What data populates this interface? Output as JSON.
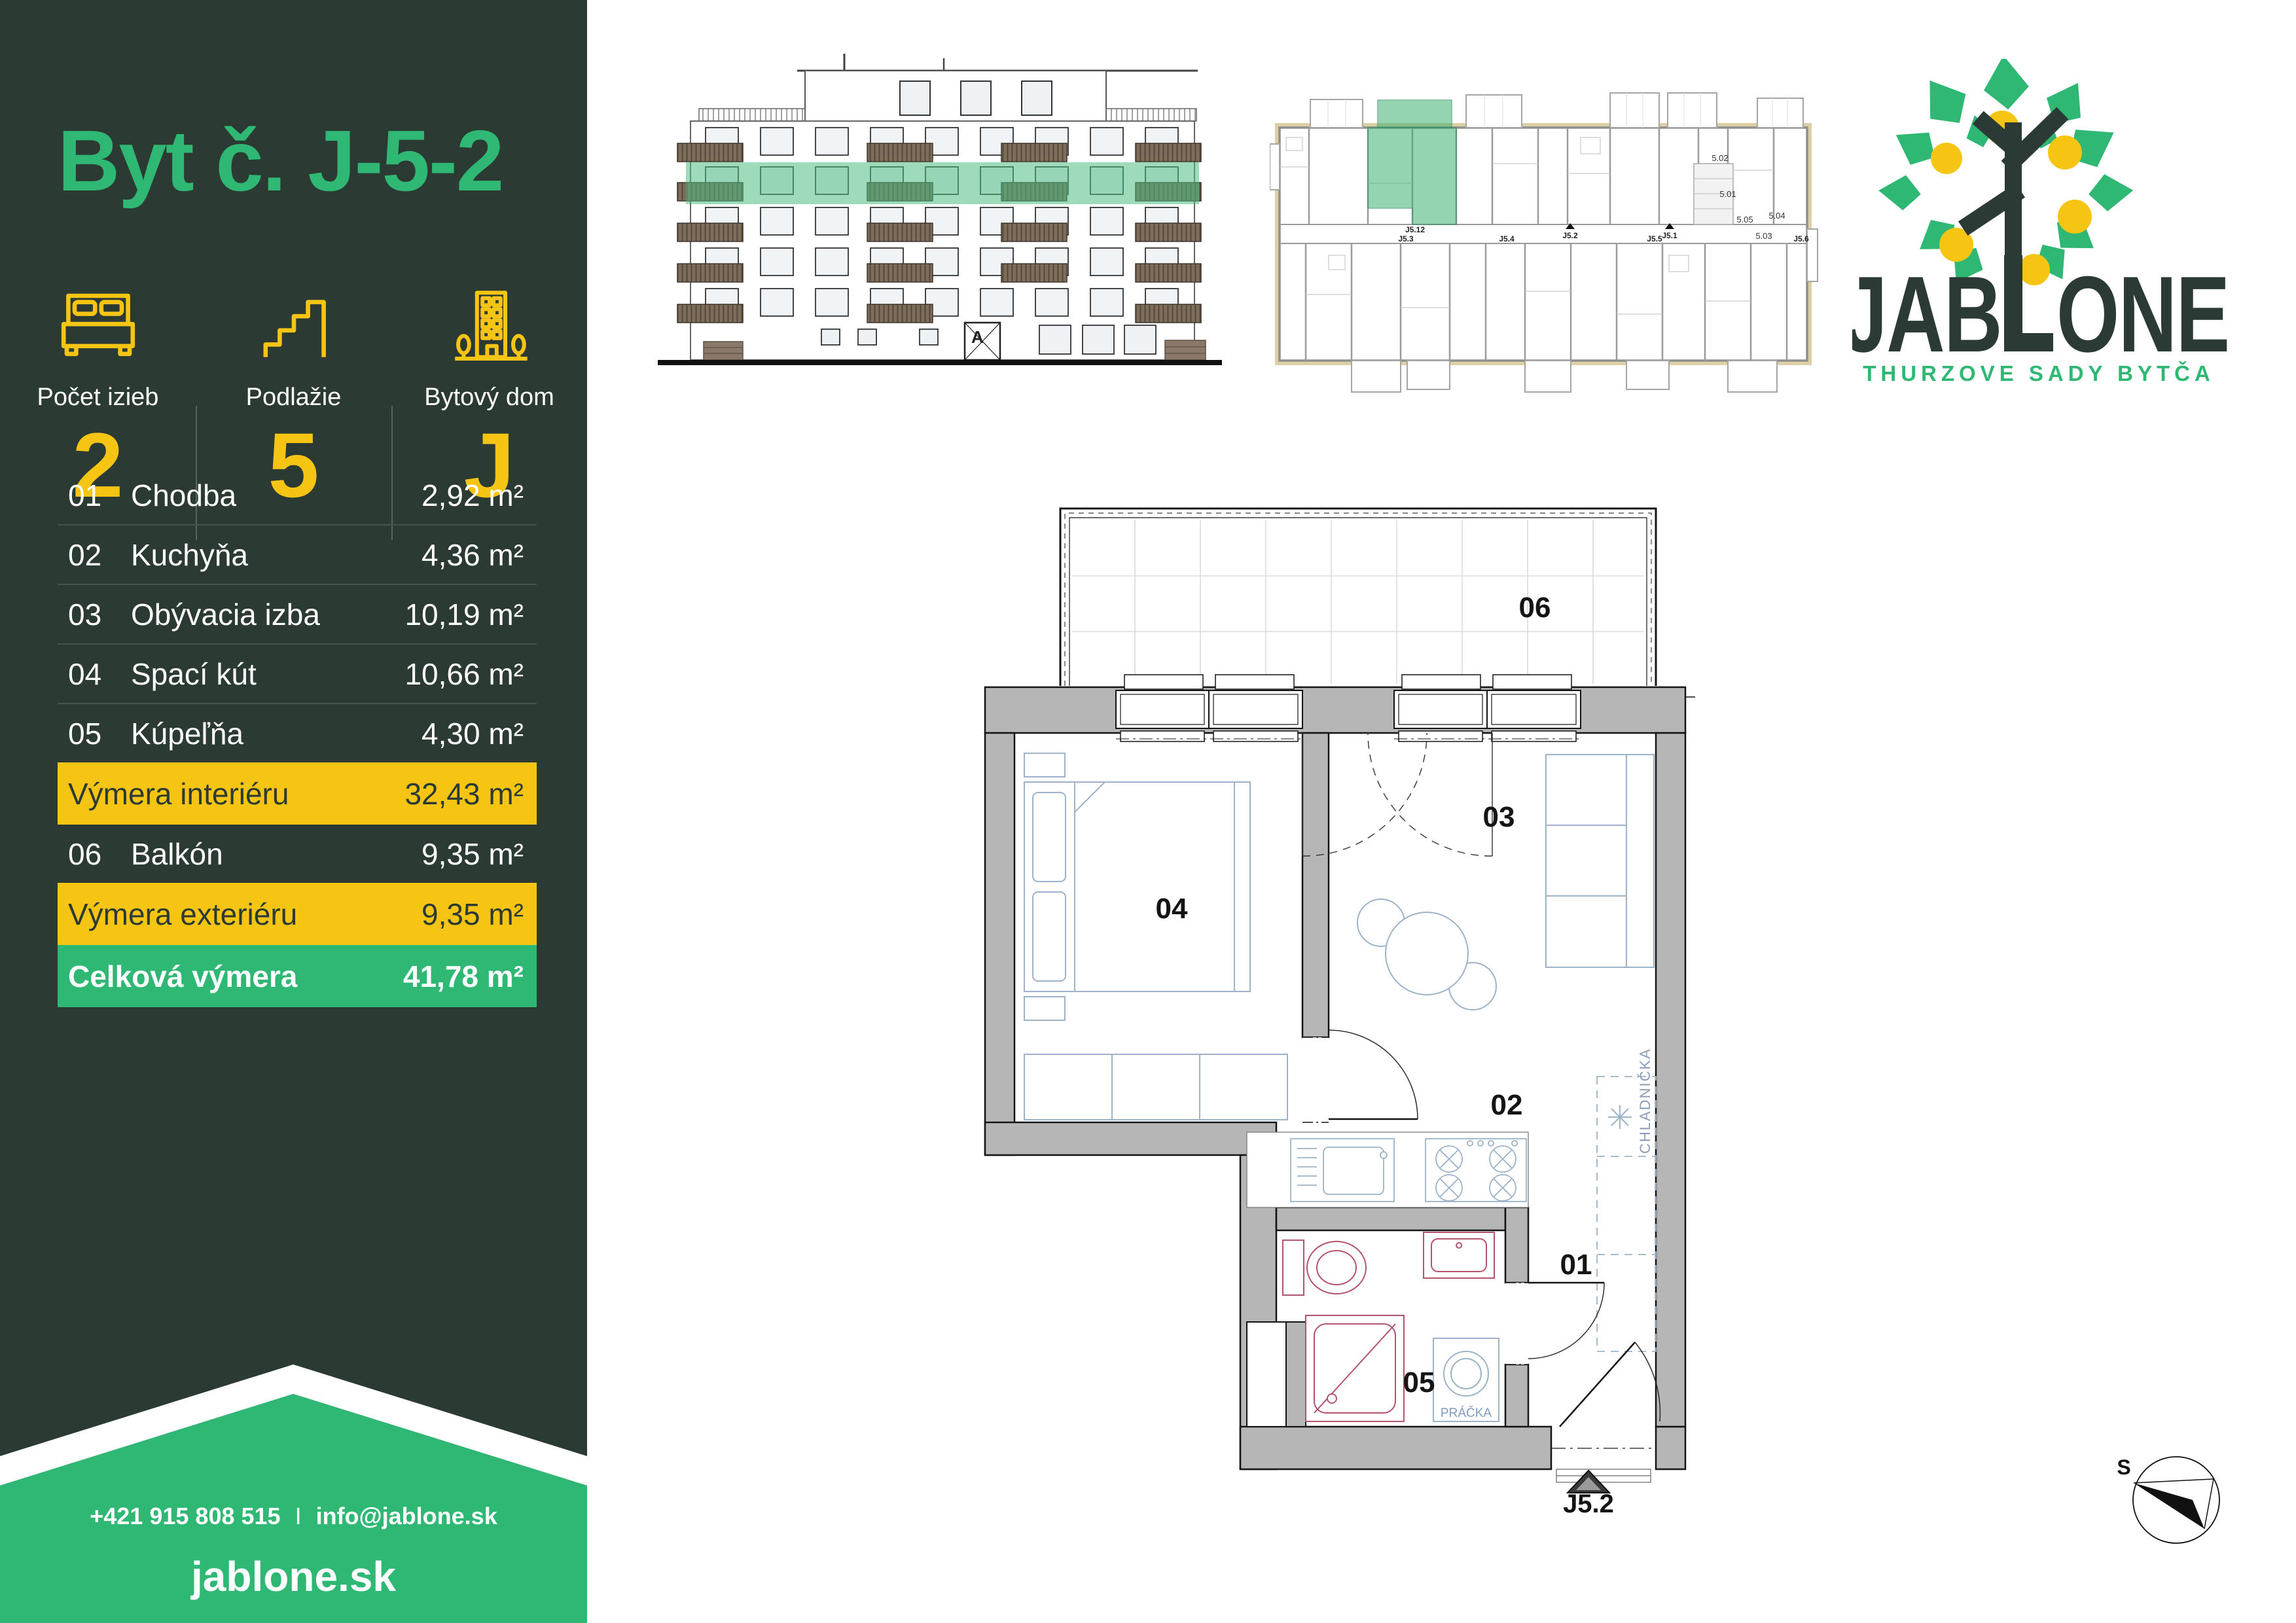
{
  "sidebar": {
    "title": "Byt č. J-5-2",
    "stats": [
      {
        "label": "Počet izieb",
        "value": "2"
      },
      {
        "label": "Podlažie",
        "value": "5"
      },
      {
        "label": "Bytový dom",
        "value": "J"
      }
    ],
    "table": [
      {
        "num": "01",
        "name": "Chodba",
        "area": "2,92 m²"
      },
      {
        "num": "02",
        "name": "Kuchyňa",
        "area": "4,36 m²"
      },
      {
        "num": "03",
        "name": "Obývacia izba",
        "area": "10,19 m²"
      },
      {
        "num": "04",
        "name": "Spací kút",
        "area": "10,66 m²"
      },
      {
        "num": "05",
        "name": "Kúpeľňa",
        "area": "4,30 m²"
      },
      {
        "label": "Výmera interiéru",
        "area": "32,43 m²"
      },
      {
        "num": "06",
        "name": "Balkón",
        "area": "9,35 m²"
      },
      {
        "label": "Výmera exteriéru",
        "area": "9,35 m²"
      },
      {
        "label": "Celková výmera",
        "area": "41,78 m²"
      }
    ],
    "contact": {
      "phone": "+421 915 808 515",
      "separator": "I",
      "email": "info@jablone.sk",
      "website": "jablone.sk"
    }
  },
  "branding": {
    "wordmark_left": "JAB",
    "wordmark_right": "ONE",
    "tagline": "THURZOVE SADY BYTČA"
  },
  "elevation": {
    "entrance_label": "A"
  },
  "siteplan": {
    "unit_labels": {
      "l1": "5.02",
      "l2": "5.01",
      "l3": "5.05",
      "l4": "5.04",
      "l5": "5.03"
    },
    "corridor_labels": {
      "j12": "J5.12",
      "j3": "J5.3",
      "j4": "J5.4",
      "j5": "J5.5",
      "j6": "J5.6",
      "j1": "J5.1",
      "j2": "J5.2"
    }
  },
  "floorplan": {
    "labels": {
      "balcony": "06",
      "bedroom": "04",
      "living": "03",
      "kitchen": "02",
      "hall": "01",
      "bath": "05"
    },
    "fridge": "CHLADNIČKA",
    "washer": "PRÁČKA",
    "entrance": "J5.2"
  },
  "compass": {
    "north": "S"
  },
  "colors": {
    "dark": "#2c3a34",
    "green": "#2eb873",
    "yellow": "#f6c514",
    "wall_gray": "#b6b6b6",
    "highlight_green": "#3db273"
  }
}
